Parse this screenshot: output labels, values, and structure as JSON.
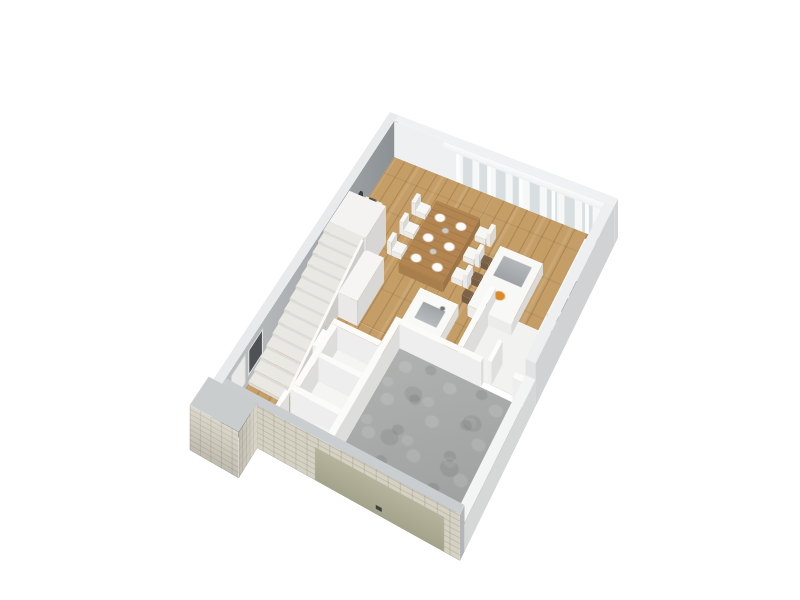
{
  "scene": {
    "description": "3D isometric render of a residential ground-floor plan on a white background",
    "background": "#ffffff",
    "level": "ground-floor",
    "palette": {
      "wood_floor": "#c59e67",
      "concrete_floor": "#a7a9a8",
      "gray_tile": "#d2d4d3",
      "white_tile": "#f5f5f3",
      "interior_wall": "#fbfbfa",
      "exterior_wall_inner": "#9aa0a4",
      "wall_cap": "#cbced0",
      "stone_facade": "#d5d1c3",
      "garage_door": "#b6b49c",
      "glass": "#d5dadc",
      "table_wood": "#b28551",
      "seating_white": "#f6f6f4",
      "island_white": "#f8f8f6",
      "appliance_dark": "#303335",
      "stool_wood": "#7d6248",
      "plant_green": "#5d7d49",
      "fruit_accent": "#d98a2b",
      "tv_dark": "#36393b",
      "stair_tread": "#eae8e3"
    },
    "rooms": [
      {
        "name": "living-dining-kitchen",
        "floor": "wood"
      },
      {
        "name": "kitchen-nook",
        "floor": "white-tile"
      },
      {
        "name": "hallway",
        "floor": "wood"
      },
      {
        "name": "staircase",
        "steps": 14
      },
      {
        "name": "wc",
        "floor": "white-tile"
      },
      {
        "name": "storage",
        "floor": "white-tile"
      },
      {
        "name": "bathroom",
        "floor": "gray-tile"
      },
      {
        "name": "garage",
        "floor": "concrete"
      }
    ],
    "furniture": [
      "tv-lowboard",
      "tv",
      "decor-bowl",
      "dining-table",
      "six-dining-chairs",
      "kitchen-island",
      "three-bar-stools",
      "appliance-counter",
      "sink-counter",
      "bathroom-vanity",
      "toilet",
      "potted-plants"
    ],
    "openings": [
      "panorama-windows-north",
      "sheer-curtains",
      "west-window",
      "entry-door",
      "garage-door",
      "stone-porch-piers"
    ]
  }
}
